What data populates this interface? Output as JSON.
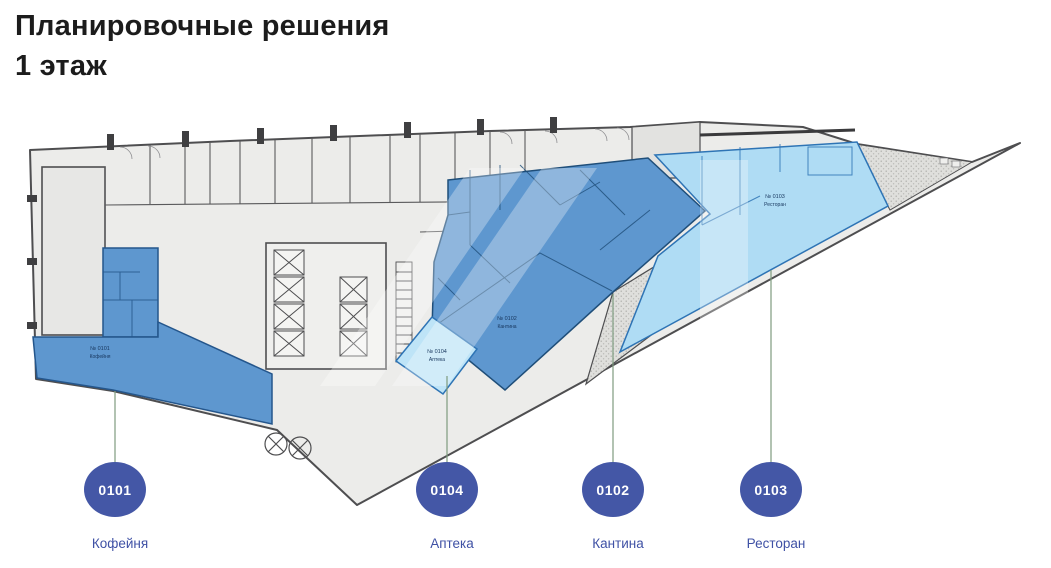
{
  "slide": {
    "title_line1": "Планировочные решения",
    "title_line2": "1 этаж"
  },
  "legend": {
    "items": [
      {
        "id": "0101",
        "name": "Кофейня"
      },
      {
        "id": "0104",
        "name": "Аптека"
      },
      {
        "id": "0102",
        "name": "Кантина"
      },
      {
        "id": "0103",
        "name": "Ресторан"
      }
    ]
  },
  "plan": {
    "unit_tags": [
      {
        "num": "№ 0101",
        "name": "Кофейня"
      },
      {
        "num": "№ 0104",
        "name": "Аптека"
      },
      {
        "num": "№ 0102",
        "name": "Кантина"
      },
      {
        "num": "№ 0103",
        "name": "Ресторан"
      }
    ]
  },
  "colors": {
    "zone_medium_blue": "#5E97CF",
    "zone_light_blue": "#AFDCF4",
    "zone_wall_dark_blue": "#1F4E79",
    "marker_circle": "#4457A6",
    "marker_label_text": "#3F51A5",
    "leader_line": "#7E9B7E",
    "plan_fill_gray": "#ECECEA",
    "wall_gray": "#4E4E50"
  }
}
